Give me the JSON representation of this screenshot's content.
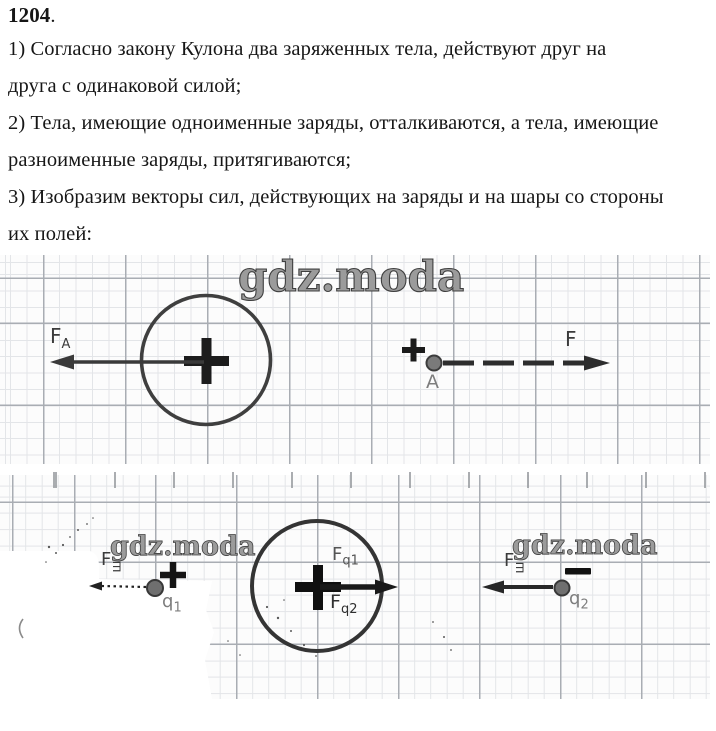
{
  "problem": {
    "number": "1204",
    "number_suffix": ".",
    "lines": [
      "1) Согласно закону Кулона два заряженных тела, действуют друг на",
      "друга с одинаковой силой;",
      "2) Тела, имеющие одноименные заряды, отталкиваются, а тела, имеющие",
      "разноименные заряды, притягиваются;",
      "3) Изобразим векторы сил, действующих на заряды и на шары со стороны",
      "их полей:"
    ]
  },
  "watermark": {
    "text": "gdz.moda"
  },
  "diagram": {
    "row1": {
      "ball_sign": "+",
      "force_on_ball": {
        "base": "F",
        "sub": "A",
        "direction": "left"
      },
      "charge_sign": "+",
      "point_label": "A",
      "force_on_charge": {
        "base": "F",
        "direction": "right"
      }
    },
    "row2": {
      "q1": {
        "base": "q",
        "sub": "1"
      },
      "q1_sign": "+",
      "force_on_q1": {
        "base": "F",
        "sub": "ш",
        "direction": "left"
      },
      "ball_sign": "+",
      "force_q1_on_ball": {
        "base": "F",
        "sub": "q1",
        "direction": "right"
      },
      "force_q2_on_ball": {
        "base": "F",
        "sub": "q2",
        "direction": "right"
      },
      "q2": {
        "base": "q",
        "sub": "2"
      },
      "q2_sign": "−",
      "force_on_q2": {
        "base": "F",
        "sub": "ш",
        "direction": "left"
      }
    },
    "colors": {
      "ink": "#2a2a2a",
      "grid_minor": "#e3e5e8",
      "grid_major": "#a9adb3",
      "label_gray": "#7e7e7e"
    }
  }
}
